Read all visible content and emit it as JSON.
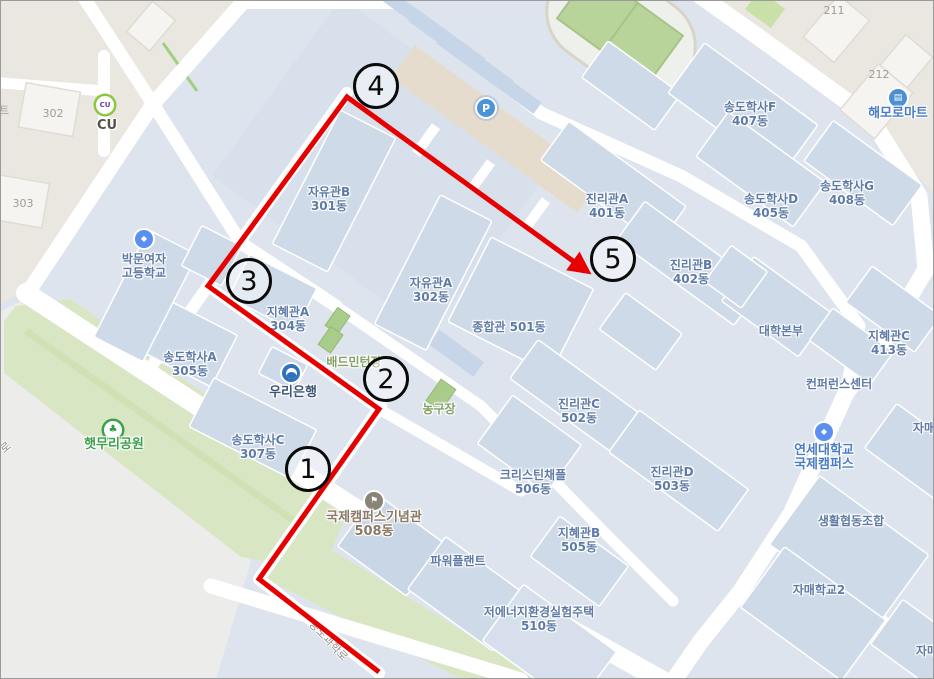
{
  "title": "캠퍼스 지도 (campus map with numbered route)",
  "colors": {
    "campus_background": "#dde4ee",
    "building_fill": "#cfdae8",
    "offcampus_beige": "#eae7e1",
    "offcampus_gray": "#ececeb",
    "park_green": "#d9e6c4",
    "field_green": "#b9d49a",
    "road_white": "#ffffff",
    "parking_beige": "#e6dccd",
    "route_red": "#e60000",
    "building_label_blue": "#5e7aa6"
  },
  "map": {
    "labels": [
      {
        "id": "jayugwan-b",
        "cls": "bldg",
        "x": 328,
        "y": 198,
        "lines": [
          "자유관B",
          "301동"
        ]
      },
      {
        "id": "jayugwan-a",
        "cls": "bldg",
        "x": 430,
        "y": 289,
        "lines": [
          "자유관A",
          "302동"
        ]
      },
      {
        "id": "jihyegwan-a",
        "cls": "bldg",
        "x": 287,
        "y": 318,
        "lines": [
          "지혜관A",
          "304동"
        ]
      },
      {
        "id": "songdo-haksa-a",
        "cls": "bldg",
        "x": 189,
        "y": 363,
        "lines": [
          "송도학사A",
          "305동"
        ]
      },
      {
        "id": "songdo-haksa-c",
        "cls": "bldg",
        "x": 257,
        "y": 446,
        "lines": [
          "송도학사C",
          "307동"
        ]
      },
      {
        "id": "jonghapgwan",
        "cls": "bldg",
        "x": 508,
        "y": 326,
        "lines": [
          "종합관 501동"
        ]
      },
      {
        "id": "jinrigwan-a",
        "cls": "bldg",
        "x": 606,
        "y": 205,
        "lines": [
          "진리관A",
          "401동"
        ]
      },
      {
        "id": "jinrigwan-b",
        "cls": "bldg",
        "x": 690,
        "y": 271,
        "lines": [
          "진리관B",
          "402동"
        ]
      },
      {
        "id": "jinrigwan-c",
        "cls": "bldg",
        "x": 578,
        "y": 410,
        "lines": [
          "진리관C",
          "502동"
        ]
      },
      {
        "id": "jinrigwan-d",
        "cls": "bldg",
        "x": 671,
        "y": 478,
        "lines": [
          "진리관D",
          "503동"
        ]
      },
      {
        "id": "songdo-haksa-f",
        "cls": "bldg",
        "x": 749,
        "y": 113,
        "lines": [
          "송도학사F",
          "407동"
        ]
      },
      {
        "id": "songdo-haksa-d",
        "cls": "bldg",
        "x": 770,
        "y": 205,
        "lines": [
          "송도학사D",
          "405동"
        ]
      },
      {
        "id": "songdo-haksa-g",
        "cls": "bldg",
        "x": 846,
        "y": 192,
        "lines": [
          "송도학사G",
          "408동"
        ]
      },
      {
        "id": "daehak-bonbu",
        "cls": "bldg",
        "x": 780,
        "y": 330,
        "lines": [
          "대학본부"
        ]
      },
      {
        "id": "jihyegwan-c",
        "cls": "bldg",
        "x": 888,
        "y": 342,
        "lines": [
          "지혜관C",
          "413동"
        ]
      },
      {
        "id": "conference-center",
        "cls": "bldg",
        "x": 838,
        "y": 383,
        "lines": [
          "컨퍼런스센터"
        ]
      },
      {
        "id": "christine-chapel",
        "cls": "bldg",
        "x": 532,
        "y": 481,
        "lines": [
          "크리스틴채플",
          "506동"
        ]
      },
      {
        "id": "jihyegwan-b",
        "cls": "bldg",
        "x": 578,
        "y": 539,
        "lines": [
          "지혜관B",
          "505동"
        ]
      },
      {
        "id": "power-plant",
        "cls": "bldg",
        "x": 457,
        "y": 560,
        "lines": [
          "파워플랜트"
        ]
      },
      {
        "id": "low-energy-house",
        "cls": "bldg",
        "x": 538,
        "y": 618,
        "lines": [
          "저에너지환경실험주택",
          "510동"
        ]
      },
      {
        "id": "saenghwal-coop",
        "cls": "bldg",
        "x": 850,
        "y": 520,
        "lines": [
          "생활협동조합"
        ]
      },
      {
        "id": "jamae-hakgyo-2",
        "cls": "bldg",
        "x": 818,
        "y": 589,
        "lines": [
          "자매학교2"
        ]
      },
      {
        "id": "jamae-hakgyo-right",
        "cls": "bldg",
        "x": 934,
        "y": 427,
        "lines": [
          "자매학교"
        ]
      },
      {
        "id": "jamae-hakgyo-bottom",
        "cls": "bldg",
        "x": 937,
        "y": 650,
        "lines": [
          "자매학교"
        ]
      },
      {
        "id": "bakmun-girls-high",
        "cls": "bldg",
        "x": 143,
        "y": 265,
        "lines": [
          "박문여자",
          "고등학교"
        ]
      },
      {
        "id": "badminton-court",
        "cls": "court",
        "x": 353,
        "y": 361,
        "lines": [
          "배드민턴장"
        ]
      },
      {
        "id": "basketball-court",
        "cls": "court",
        "x": 438,
        "y": 408,
        "lines": [
          "농구장"
        ]
      },
      {
        "id": "bldg-302",
        "cls": "gray",
        "x": 52,
        "y": 113,
        "lines": [
          "302"
        ]
      },
      {
        "id": "bldg-303",
        "cls": "gray",
        "x": 22,
        "y": 203,
        "lines": [
          "303"
        ]
      },
      {
        "id": "bldg-211",
        "cls": "gray",
        "x": 833,
        "y": 10,
        "lines": [
          "211"
        ]
      },
      {
        "id": "bldg-212",
        "cls": "gray",
        "x": 878,
        "y": 74,
        "lines": [
          "212"
        ]
      },
      {
        "id": "cu-store",
        "cls": "poi-dark",
        "x": 106,
        "y": 125,
        "lines": [
          "CU"
        ]
      },
      {
        "id": "woori-bank",
        "cls": "poi-navy",
        "x": 292,
        "y": 392,
        "lines": [
          "우리은행"
        ]
      },
      {
        "id": "haetmuri-park",
        "cls": "poi-green",
        "x": 113,
        "y": 444,
        "lines": [
          "햇무리공원"
        ]
      },
      {
        "id": "memorial-hall",
        "cls": "poi-brown",
        "x": 373,
        "y": 524,
        "lines": [
          "국제캠퍼스기념관",
          "508동"
        ]
      },
      {
        "id": "yonsei-intl-campus",
        "cls": "poi-blue",
        "x": 823,
        "y": 457,
        "lines": [
          "연세대학교",
          "국제캠퍼스"
        ]
      },
      {
        "id": "haemoro-mart",
        "cls": "poi-blue",
        "x": 897,
        "y": 113,
        "lines": [
          "해모로마트"
        ]
      },
      {
        "id": "songdo-science-ro",
        "cls": "road",
        "x": 327,
        "y": 640,
        "rot": 47,
        "lines": [
          "송도과학로"
        ]
      },
      {
        "id": "road-ro-partial",
        "cls": "road",
        "x": 5,
        "y": 447,
        "rot": -40,
        "lines": [
          "로"
        ]
      },
      {
        "id": "road-teu-partial",
        "cls": "gray",
        "x": 3,
        "y": 110,
        "rot": 0,
        "lines": [
          "트"
        ]
      }
    ],
    "icons": [
      {
        "id": "cu-icon",
        "type": "cu",
        "x": 104,
        "y": 104,
        "glyph": "CU"
      },
      {
        "id": "school-icon",
        "type": "school",
        "x": 143,
        "y": 238,
        "glyph": "◆"
      },
      {
        "id": "bank-icon",
        "type": "bank",
        "x": 290,
        "y": 372,
        "glyph": ""
      },
      {
        "id": "park-icon",
        "type": "park",
        "x": 112,
        "y": 429,
        "glyph": "♣"
      },
      {
        "id": "memorial-icon",
        "type": "memorial",
        "x": 373,
        "y": 500,
        "glyph": "⚑"
      },
      {
        "id": "univ-icon",
        "type": "univ",
        "x": 823,
        "y": 431,
        "glyph": "◆"
      },
      {
        "id": "mart-icon",
        "type": "mart",
        "x": 897,
        "y": 97,
        "glyph": "▤"
      },
      {
        "id": "parking-icon",
        "type": "parking",
        "x": 485,
        "y": 107,
        "glyph": "P"
      }
    ],
    "route": {
      "color": "#e60000",
      "width": 5,
      "points": "378,671 258,578 378,408 207,285 346,96 583,268",
      "waypoints": [
        {
          "n": "1",
          "x": 307,
          "y": 468
        },
        {
          "n": "2",
          "x": 385,
          "y": 378
        },
        {
          "n": "3",
          "x": 248,
          "y": 280
        },
        {
          "n": "4",
          "x": 375,
          "y": 85
        },
        {
          "n": "5",
          "x": 612,
          "y": 258
        }
      ]
    }
  }
}
